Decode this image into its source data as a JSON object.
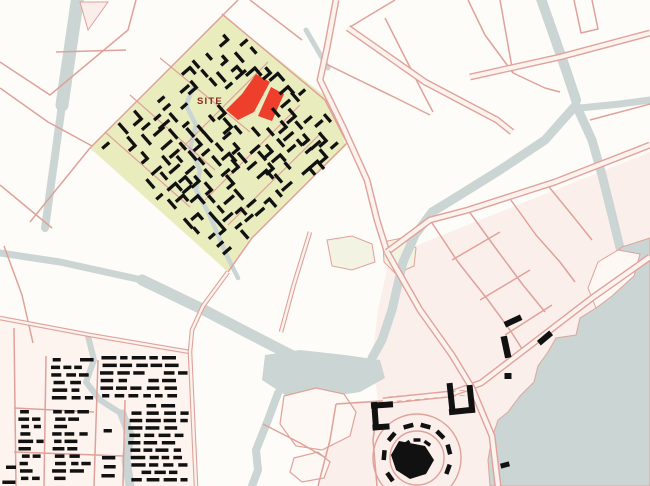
{
  "site_label": {
    "text": "SITE",
    "x": 197,
    "y": 104
  },
  "palette": {
    "background": "#fdfcf9",
    "road_casing": "#e0a29a",
    "road_fill": "#fcf3ef",
    "road_minor": "#dfa29a",
    "water": "#cbd5d4",
    "water_edge": "#d9a79e",
    "site_green": "#e9edbe",
    "park_faint": "#f3f3e3",
    "park_white": "#fdf8f4",
    "tint_downtown": "#fbefeb",
    "tint_housing": "#fdf3ef",
    "highlight_red": "#ee3e2c",
    "label_red": "#8b2b1c",
    "building_black": "#111111"
  },
  "tints": {
    "downtown": [
      650,
      152,
      390,
      256,
      378,
      310,
      372,
      360,
      378,
      400,
      332,
      403,
      318,
      486,
      650,
      486
    ],
    "housing": [
      0,
      320,
      190,
      352,
      196,
      486,
      0,
      486
    ]
  },
  "greens": {
    "diamond": [
      222,
      15,
      330,
      100,
      346,
      146,
      300,
      190,
      252,
      238,
      228,
      272,
      90,
      148
    ],
    "faint": [
      [
        327,
        240,
        352,
        236,
        372,
        244,
        375,
        262,
        352,
        270,
        332,
        266
      ],
      [
        383,
        242,
        402,
        238,
        416,
        248,
        414,
        266,
        396,
        274,
        384,
        262
      ]
    ]
  },
  "parks": [
    [
      284,
      396,
      316,
      388,
      344,
      394,
      356,
      412,
      350,
      436,
      322,
      450,
      296,
      446,
      280,
      424
    ],
    [
      294,
      458,
      318,
      452,
      330,
      462,
      324,
      478,
      302,
      482,
      290,
      472
    ]
  ],
  "peninsula": [
    598,
    262,
    618,
    250,
    640,
    254,
    634,
    276,
    612,
    296,
    596,
    308,
    588,
    288
  ],
  "triangle": [
    80,
    2,
    108,
    2,
    88,
    30
  ],
  "water": {
    "strokes": [
      {
        "w": 13,
        "pts": [
          78,
          -4,
          62,
          105
        ]
      },
      {
        "w": 8,
        "pts": [
          62,
          105,
          45,
          228
        ]
      },
      {
        "w": 7,
        "pts": [
          0,
          253,
          60,
          262,
          142,
          280
        ]
      },
      {
        "w": 11,
        "pts": [
          142,
          280,
          200,
          308,
          250,
          334,
          285,
          352,
          320,
          370
        ]
      },
      {
        "w": 8,
        "pts": [
          278,
          393,
          268,
          420,
          256,
          450,
          258,
          470,
          252,
          486
        ]
      },
      {
        "w": 10,
        "pts": [
          540,
          -4,
          552,
          30,
          566,
          70,
          576,
          100
        ]
      },
      {
        "w": 9,
        "pts": [
          576,
          105,
          545,
          140,
          500,
          170,
          455,
          198,
          432,
          212,
          415,
          235,
          403,
          262,
          392,
          310,
          382,
          340,
          372,
          358
        ]
      },
      {
        "w": 9,
        "pts": [
          576,
          105,
          592,
          140,
          602,
          175,
          612,
          215,
          620,
          248
        ]
      },
      {
        "w": 7,
        "pts": [
          580,
          108,
          620,
          104,
          650,
          100
        ]
      },
      {
        "w": 4.5,
        "pts": [
          193,
          88,
          186,
          105,
          196,
          125,
          190,
          148,
          200,
          170,
          196,
          190,
          208,
          212,
          218,
          235,
          228,
          258,
          238,
          278
        ]
      },
      {
        "w": 6,
        "pts": [
          88,
          336,
          94,
          360,
          86,
          382,
          100,
          400,
          122,
          414
        ]
      },
      {
        "w": 9,
        "pts": [
          122,
          414,
          130,
          435,
          126,
          460,
          130,
          486
        ]
      },
      {
        "w": 5,
        "pts": [
          306,
          30,
          328,
          68
        ]
      }
    ],
    "pond": [
      265,
      355,
      300,
      350,
      345,
      355,
      380,
      360,
      385,
      378,
      360,
      392,
      320,
      398,
      285,
      395,
      262,
      380
    ],
    "sea": [
      650,
      238,
      622,
      247,
      605,
      260,
      596,
      275,
      608,
      288,
      596,
      308,
      580,
      318,
      576,
      335,
      556,
      338,
      548,
      352,
      538,
      366,
      534,
      382,
      520,
      396,
      508,
      412,
      498,
      420,
      492,
      438,
      488,
      460,
      490,
      486,
      650,
      486
    ]
  },
  "roads": {
    "major": [
      [
        336,
        0,
        327,
        48,
        320,
        80,
        343,
        127,
        367,
        180,
        377,
        220,
        387,
        252
      ],
      [
        348,
        28,
        425,
        82,
        497,
        120,
        512,
        132
      ],
      [
        470,
        77,
        560,
        57,
        650,
        33
      ],
      [
        650,
        145,
        555,
        182,
        468,
        210,
        430,
        220,
        387,
        252
      ],
      [
        650,
        257,
        592,
        298,
        532,
        344,
        481,
        383,
        450,
        394,
        383,
        401
      ],
      [
        387,
        252,
        420,
        310,
        452,
        355,
        472,
        388,
        492,
        436,
        498,
        486
      ]
    ],
    "mid": [
      [
        0,
        318,
        90,
        335,
        190,
        352
      ],
      [
        190,
        352,
        196,
        486
      ],
      [
        228,
        272,
        203,
        306,
        192,
        330,
        190,
        352
      ],
      [
        310,
        232,
        294,
        284,
        281,
        332
      ]
    ],
    "minor": [
      [
        238,
        0,
        222,
        16,
        90,
        148,
        30,
        222
      ],
      [
        222,
        14,
        325,
        100,
        347,
        143
      ],
      [
        347,
        143,
        300,
        190,
        252,
        238,
        228,
        272
      ],
      [
        0,
        185,
        52,
        228
      ],
      [
        0,
        62,
        50,
        95,
        128,
        30,
        136,
        0
      ],
      [
        0,
        88,
        48,
        122,
        92,
        146
      ],
      [
        56,
        52,
        126,
        50
      ],
      [
        395,
        0,
        350,
        27
      ],
      [
        250,
        0,
        302,
        40
      ],
      [
        500,
        0,
        513,
        73
      ],
      [
        468,
        0,
        485,
        35,
        513,
        73
      ],
      [
        513,
        73,
        545,
        88,
        560,
        92
      ],
      [
        574,
        0,
        581,
        33,
        598,
        29,
        592,
        0
      ],
      [
        590,
        120,
        650,
        104
      ],
      [
        385,
        18,
        423,
        93,
        433,
        112
      ],
      [
        14,
        328,
        16,
        486
      ],
      [
        46,
        356,
        44,
        486
      ],
      [
        98,
        360,
        94,
        486
      ],
      [
        125,
        400,
        123,
        486
      ],
      [
        14,
        408,
        94,
        412
      ],
      [
        14,
        452,
        123,
        456
      ],
      [
        4,
        246,
        22,
        295,
        33,
        343
      ],
      [
        430,
        220,
        458,
        262,
        488,
        300,
        510,
        330,
        524,
        352
      ],
      [
        468,
        210,
        497,
        250,
        523,
        285,
        545,
        312
      ],
      [
        508,
        196,
        536,
        235,
        560,
        262,
        575,
        282
      ],
      [
        545,
        182,
        572,
        215,
        592,
        240
      ],
      [
        452,
        260,
        500,
        232
      ],
      [
        480,
        300,
        530,
        270
      ],
      [
        505,
        335,
        552,
        305
      ],
      [
        378,
        403,
        373,
        440,
        377,
        486
      ],
      [
        318,
        486,
        330,
        440,
        336,
        404
      ],
      [
        336,
        404,
        383,
        401
      ],
      [
        263,
        424,
        300,
        443,
        326,
        458
      ],
      [
        322,
        62,
        400,
        100,
        430,
        115
      ]
    ],
    "internal": [
      [
        160,
        58,
        250,
        132
      ],
      [
        130,
        95,
        215,
        170
      ],
      [
        105,
        132,
        190,
        207
      ],
      [
        268,
        62,
        172,
        158
      ],
      [
        300,
        105,
        205,
        200
      ],
      [
        322,
        132,
        228,
        225
      ]
    ],
    "dashed": [
      [
        388,
        397,
        468,
        390
      ],
      [
        388,
        402,
        468,
        395
      ]
    ],
    "rings": [
      {
        "cx": 417,
        "cy": 458,
        "r": 44
      },
      {
        "cx": 417,
        "cy": 458,
        "r": 27
      }
    ]
  },
  "red_buildings": [
    [
      226,
      110,
      238,
      120,
      254,
      112,
      270,
      82,
      256,
      74,
      242,
      94
    ],
    [
      258,
      116,
      272,
      121,
      284,
      94,
      271,
      87
    ]
  ],
  "site_cluster": {
    "cx": 218,
    "cy": 146,
    "angle": -41,
    "step": 12.5,
    "span": 125,
    "jitter": 6,
    "seed": 11,
    "exclusions": [
      [
        254,
        99,
        25
      ],
      [
        207,
        99,
        15
      ],
      [
        120,
        170,
        28
      ]
    ]
  },
  "housing_blocks": [
    [
      2,
      458,
      16,
      486,
      7.5,
      0.9
    ],
    [
      50,
      358,
      95,
      404,
      7.6,
      0.92
    ],
    [
      100,
      356,
      190,
      402,
      7.6,
      0.92
    ],
    [
      18,
      410,
      44,
      486,
      7.4,
      0.92
    ],
    [
      52,
      410,
      92,
      486,
      7.4,
      0.9
    ],
    [
      128,
      404,
      190,
      486,
      7.4,
      0.92
    ],
    [
      100,
      420,
      122,
      486,
      9,
      0.55
    ]
  ],
  "downtown_shapes": [
    [
      513,
      321,
      18,
      6,
      -25
    ],
    [
      506,
      347,
      6.5,
      22,
      -12
    ],
    [
      545,
      338,
      16,
      6,
      -40
    ],
    [
      508,
      376,
      7,
      6,
      0
    ],
    [
      505,
      465,
      9,
      5,
      -15
    ],
    [
      451,
      397,
      6,
      28,
      -6
    ],
    [
      471,
      399,
      6,
      28,
      -6
    ],
    [
      461,
      411,
      24,
      6,
      -6
    ],
    [
      382,
      405,
      22,
      6,
      -4
    ],
    [
      375,
      414,
      6,
      24,
      -4
    ],
    [
      381,
      427,
      17,
      6,
      -4
    ]
  ],
  "plaza": {
    "cx": 417,
    "cy": 458,
    "blob": [
      399,
      441,
      425,
      446,
      434,
      460,
      426,
      474,
      410,
      479,
      396,
      470,
      391,
      455
    ],
    "bars": {
      "r": 33,
      "angles": [
        -20,
        15,
        45,
        75,
        105,
        140,
        175,
        215
      ],
      "w": 10,
      "h": 4.5
    },
    "inner": {
      "r": 18,
      "angles": [
        55,
        90,
        125,
        160
      ],
      "w": 7,
      "h": 3.5
    }
  }
}
